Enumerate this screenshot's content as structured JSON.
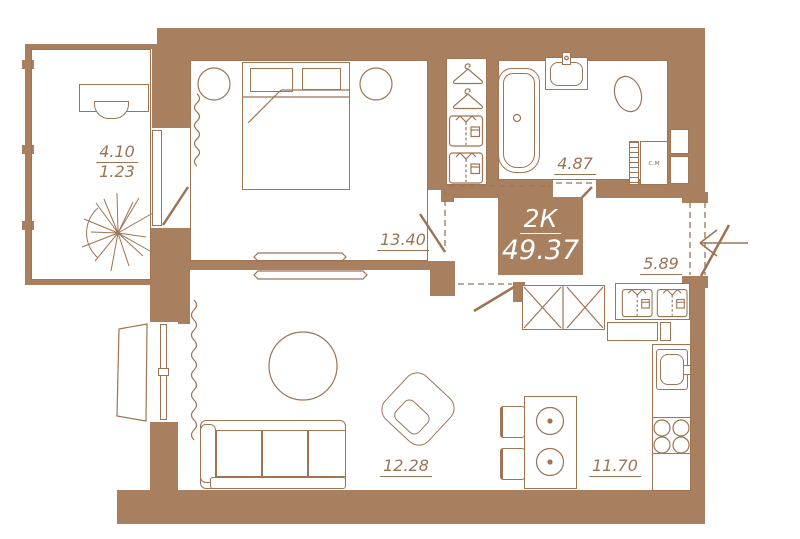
{
  "summary": {
    "type_label": "2К",
    "total_area": "49.37"
  },
  "rooms": {
    "balcony": {
      "label_full": "4.10",
      "label_reduced": "1.23"
    },
    "bedroom": {
      "label": "13.40"
    },
    "bathroom": {
      "label": "4.87"
    },
    "hallway": {
      "label": "5.89"
    },
    "living_room": {
      "label": "12.28"
    },
    "kitchen": {
      "label": "11.70"
    }
  },
  "appliances": {
    "washing_machine_label": "с.м"
  },
  "colors": {
    "wall": "#a8805f",
    "line": "#9e7453",
    "label_text": "#9b7355",
    "info_text": "#ffffff",
    "background": "#ffffff"
  }
}
